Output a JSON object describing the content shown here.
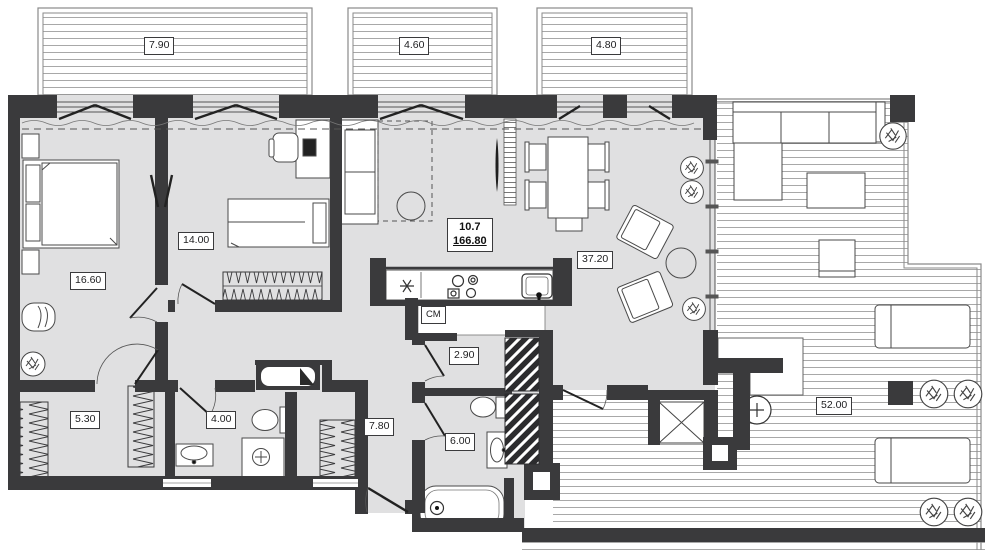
{
  "title": "Apartment floor plan with terrace",
  "balconies": [
    {
      "name": "left balcony",
      "area": "7.90"
    },
    {
      "name": "middle balcony",
      "area": "4.60"
    },
    {
      "name": "right balcony",
      "area": "4.80"
    }
  ],
  "rooms": {
    "bedroom_master": {
      "name": "master bedroom",
      "area": "16.60"
    },
    "bedroom_second": {
      "name": "second bedroom",
      "area": "14.00"
    },
    "living_kitchen": {
      "name": "living room / kitchen",
      "area": "37.20"
    },
    "wardrobe": {
      "name": "wardrobe",
      "area": "5.30"
    },
    "bathroom_guest": {
      "name": "guest bathroom",
      "area": "4.00"
    },
    "storage": {
      "name": "storage",
      "area": "2.90"
    },
    "hallway": {
      "name": "hallway",
      "area": "7.80"
    },
    "bathroom_main": {
      "name": "main bathroom",
      "area": "6.00"
    },
    "terrace": {
      "name": "terrace",
      "area": "52.00"
    }
  },
  "summary": {
    "unit": "10.7",
    "total_area": "166.80"
  },
  "labels": {
    "washer": "СМ"
  },
  "colors": {
    "wall": "#3a3a3c",
    "floor": "#e0e0e1",
    "deck_line": "#a8a8a8"
  }
}
